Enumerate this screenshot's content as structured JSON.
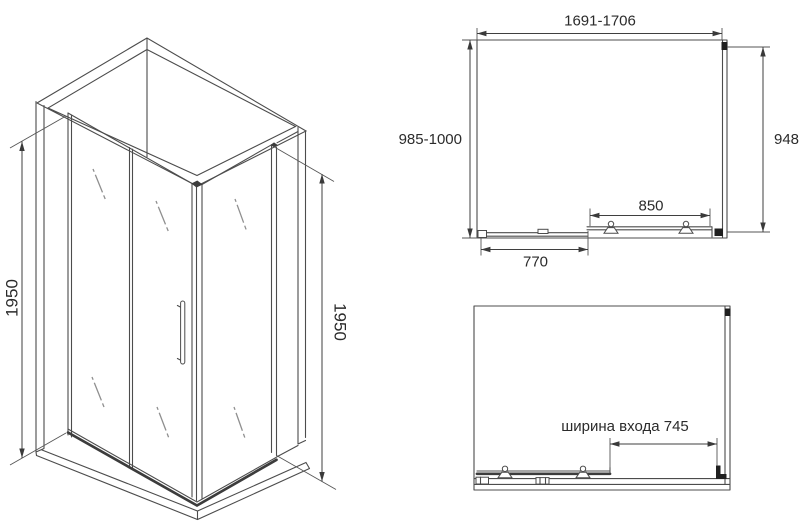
{
  "drawing": {
    "subject": "corner shower enclosure technical dimension drawing",
    "colors": {
      "background": "#ffffff",
      "line": "#4c4c4c",
      "text": "#2b2b2b"
    },
    "isometric": {
      "left_height": "1950",
      "right_height": "1950"
    },
    "plan": {
      "width_range": "1691-1706",
      "depth_range": "985-1000",
      "side_panel": "948",
      "door_width": "850",
      "fixed_panel": "770"
    },
    "entry": {
      "label": "ширина входа 745"
    }
  }
}
